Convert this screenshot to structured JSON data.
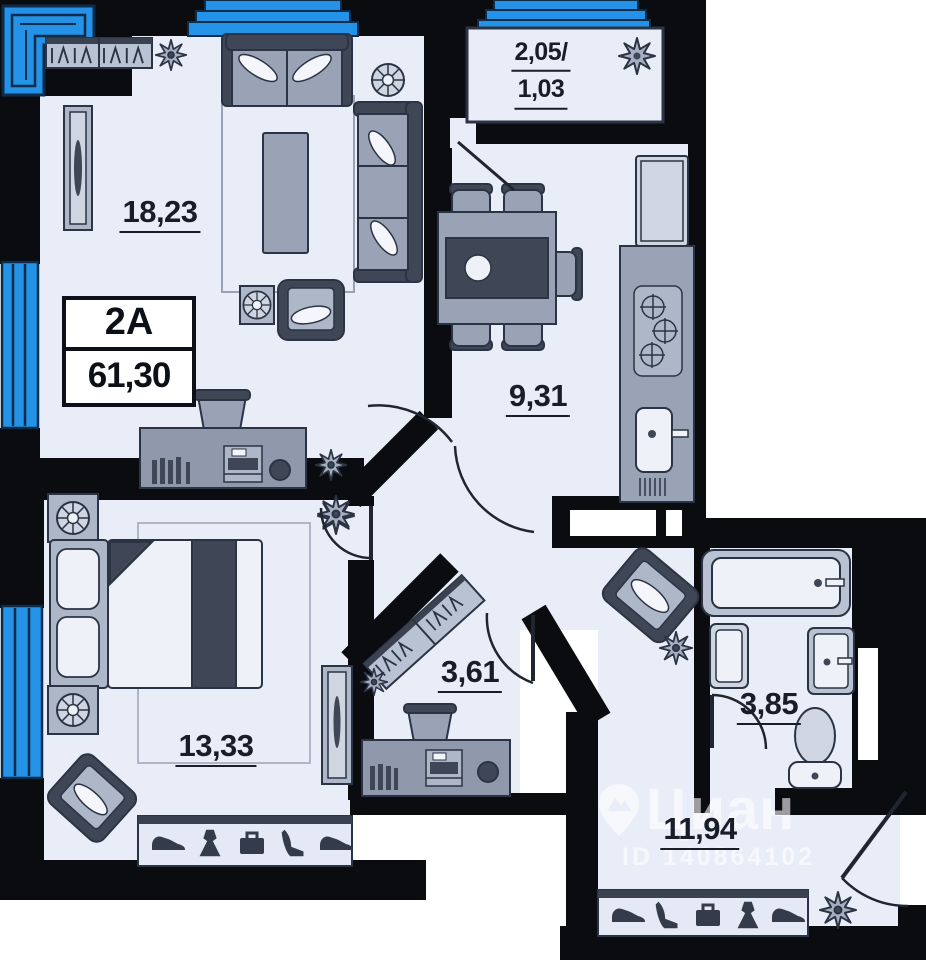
{
  "unit_card": {
    "unit_label": "2A",
    "total_area": "61,30"
  },
  "rooms": {
    "living": {
      "area": "18,23"
    },
    "kitchen": {
      "area": "9,31"
    },
    "bedroom": {
      "area": "13,33"
    },
    "hall": {
      "area": "3,61"
    },
    "bathroom": {
      "area": "3,85"
    },
    "corridor": {
      "area": "11,94"
    },
    "balcony": {
      "area_full": "2,05/",
      "area_reduced": "1,03"
    }
  },
  "watermark": {
    "brand": "Циан",
    "listing_id": "ID 140864102"
  },
  "closet_icons": {
    "bedroom": [
      "sneaker-icon",
      "dress-icon",
      "briefcase-icon",
      "high-heel-icon",
      "sneaker-icon"
    ],
    "corridor": [
      "sneaker-icon",
      "high-heel-icon",
      "briefcase-icon",
      "dress-icon",
      "sneaker-icon"
    ]
  },
  "colors": {
    "wall": "#0b0c10",
    "floor": "#e9edf8",
    "window_blue": "#2492e6",
    "window_line": "#0d2c49",
    "furniture_light": "#cfd6e2",
    "furniture_mid": "#9aa3b5",
    "furniture_dark": "#3f4756",
    "outline": "#2b3444",
    "label_text": "#181d28",
    "background": "#ffffff"
  }
}
